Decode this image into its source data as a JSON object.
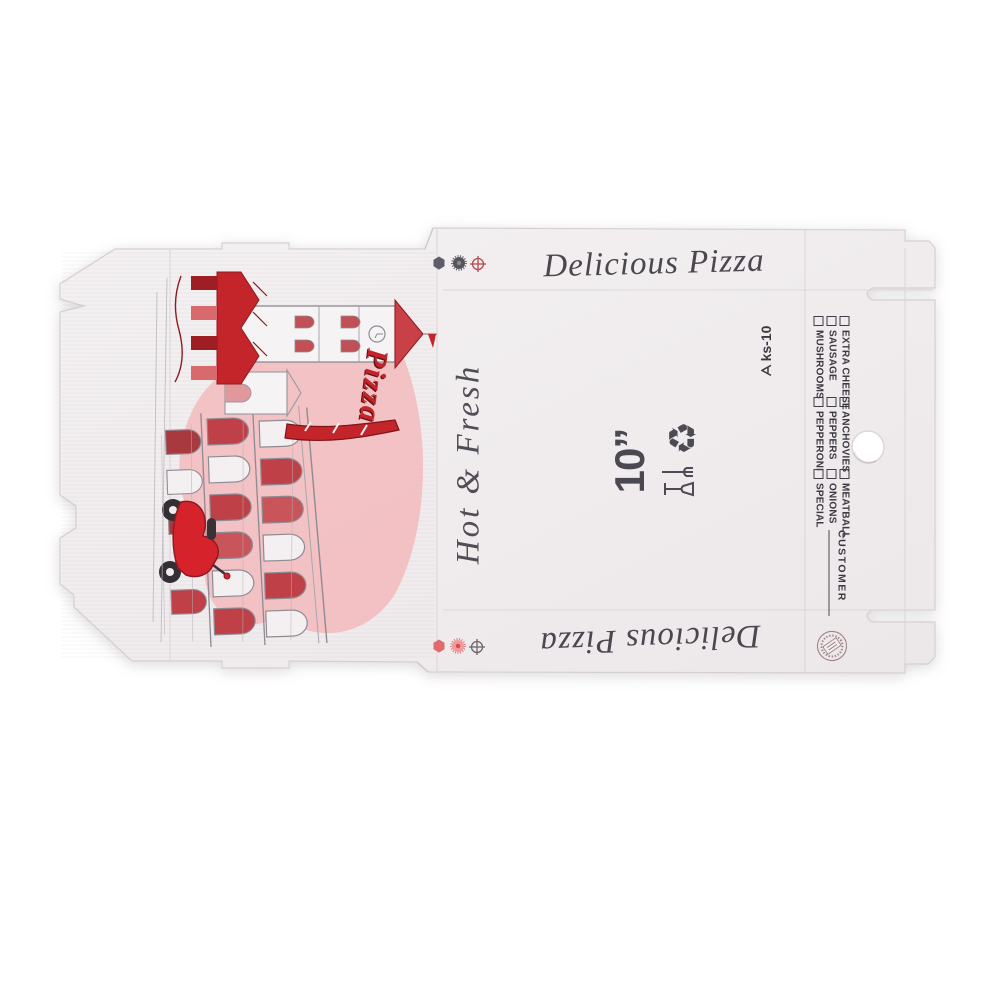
{
  "box": {
    "brand_top": "Delicious Pizza",
    "brand_bottom": "Delicious Pizza",
    "tagline": "Hot & Fresh",
    "pizza_script": "Pizza",
    "size_label": "10”",
    "model_code": "ks-10",
    "customer_label": "CUSTOMER"
  },
  "toppings": {
    "group1": [
      "EXTRA CHEESE",
      "SAUSAGE",
      "MUSHROOMS"
    ],
    "group2": [
      "ANCHOVIES",
      "PEPPERS",
      "PEPPERONI"
    ],
    "group3": [
      "MEATBALL",
      "ONIONS",
      "SPECIAL"
    ]
  },
  "icons": {
    "recycle_symbol": "♻",
    "food_safe": "glass-and-fork",
    "registration_marks": "hexagon, gear, crosshair",
    "stamp": "round certification stamp",
    "brand_logo": "triangle mark"
  },
  "colors": {
    "accent_red": "#c2242a",
    "pink_wash": "#f2b6ba",
    "ink": "#45434b",
    "sheet": "#f0ecee"
  }
}
